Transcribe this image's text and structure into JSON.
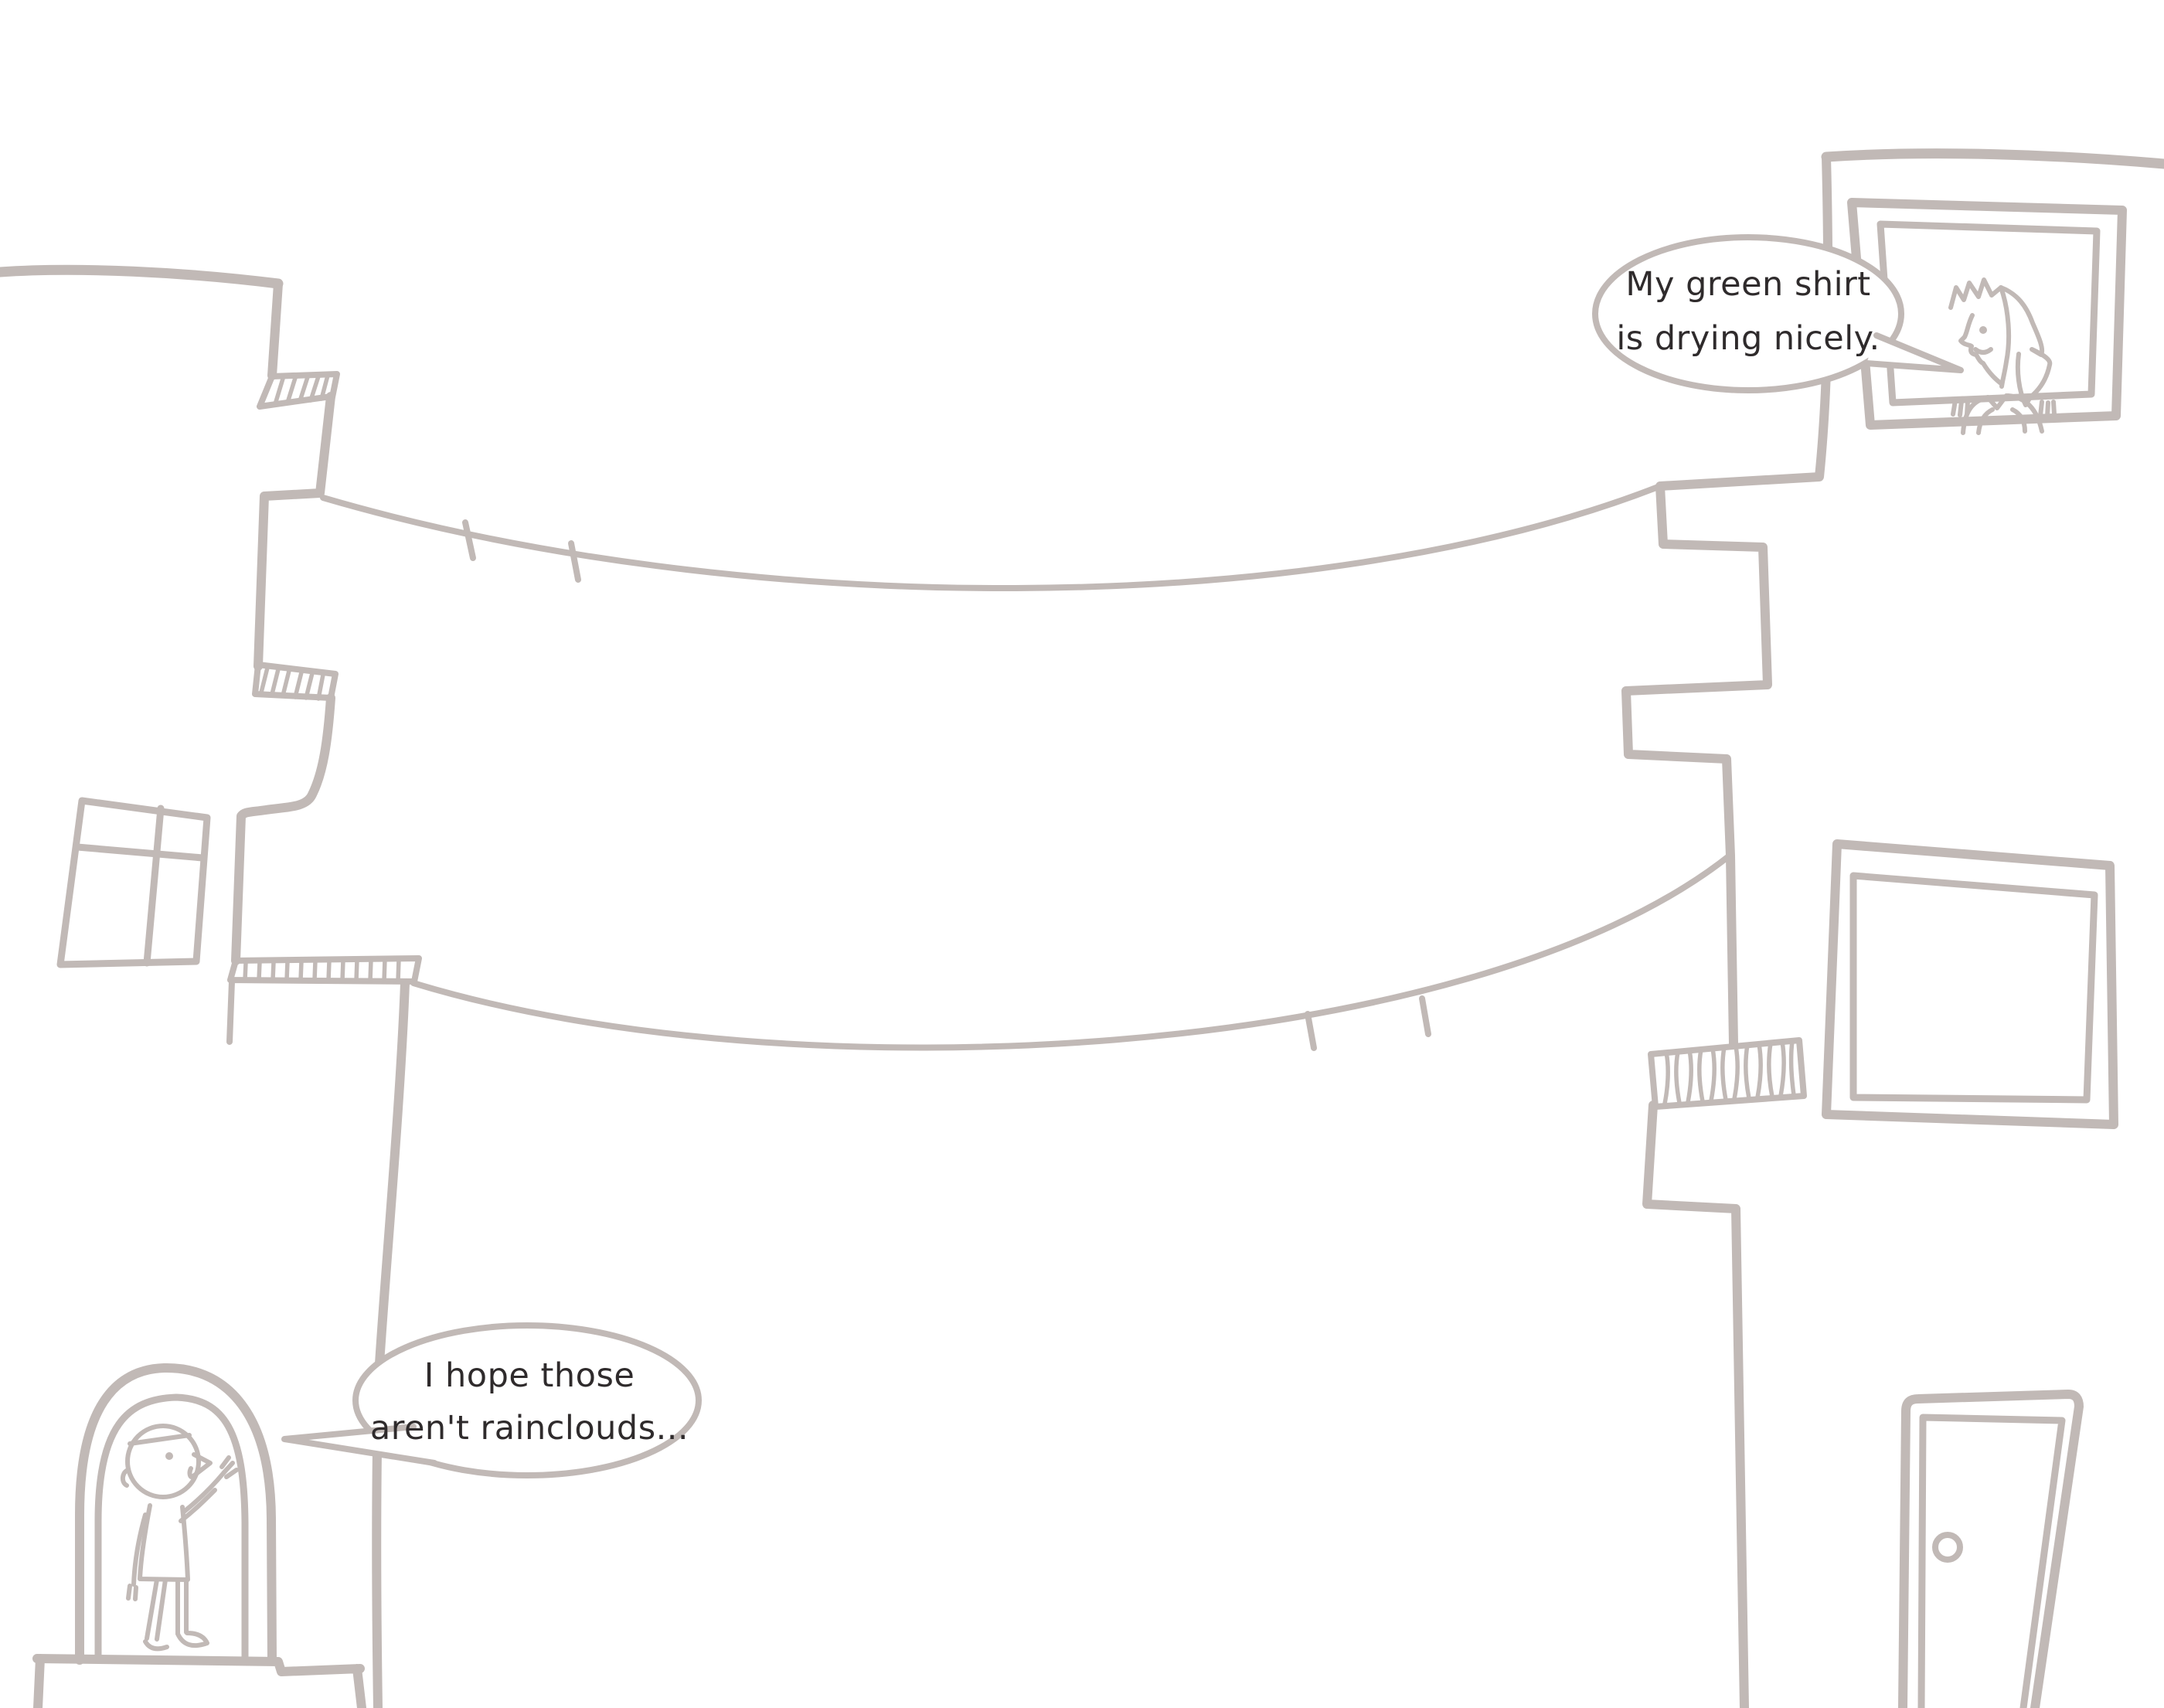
{
  "illustration": {
    "background_color": "#ffffff",
    "line_color": "#c1b9b6",
    "text_color": "#2f2b2c",
    "speech_bubbles": {
      "woman": {
        "line1": "My green shirt",
        "line2": "is drying nicely."
      },
      "man": {
        "line1": "I hope those",
        "line2": "aren't rainclouds..."
      }
    }
  }
}
